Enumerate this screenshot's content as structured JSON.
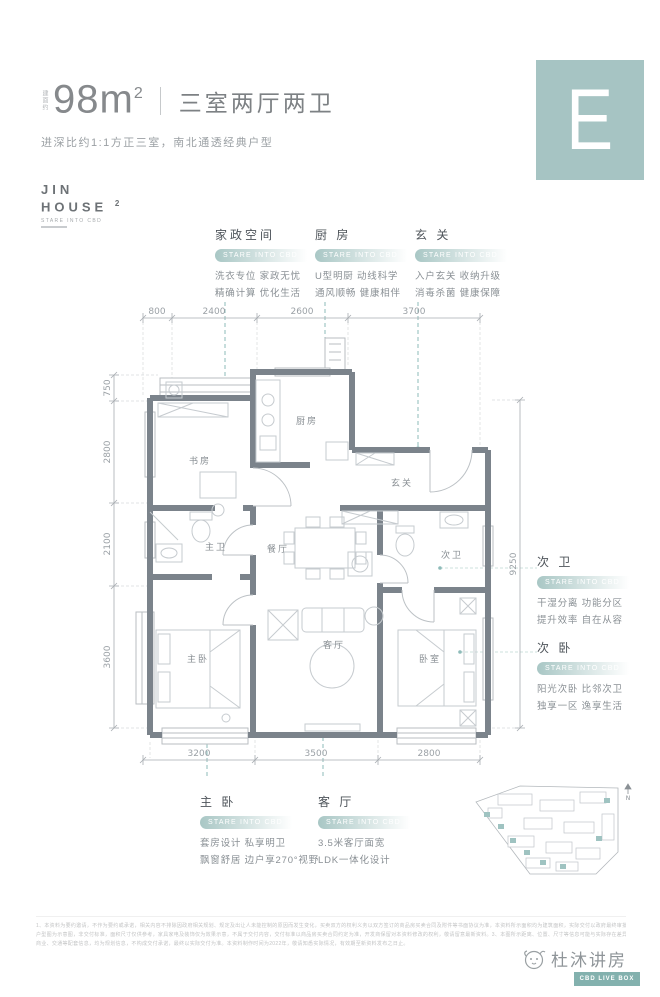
{
  "header": {
    "area_prefix": "建面约",
    "area_value": "98m",
    "area_sup": "2",
    "title": "三室两厅两卫",
    "subtitle": "进深比约1:1方正三室，南北通透经典户型",
    "tile_letter": "E"
  },
  "logo": {
    "line1": "JIN",
    "line2": "HOUSE",
    "sup": "2",
    "tagline": "STARE INTO CBD"
  },
  "badge_label": "STARE INTO CBD",
  "annotations": {
    "top": [
      {
        "title": "家政空间",
        "desc1": "洗衣专位 家政无忧",
        "desc2": "精确计算 优化生活"
      },
      {
        "title": "厨 房",
        "desc1": "U型明厨 动线科学",
        "desc2": "通风顺畅 健康相伴"
      },
      {
        "title": "玄 关",
        "desc1": "入户玄关 收纳升级",
        "desc2": "消毒杀菌 健康保障"
      }
    ],
    "right": [
      {
        "title": "次 卫",
        "desc1": "干湿分离 功能分区",
        "desc2": "提升效率 自在从容"
      },
      {
        "title": "次 卧",
        "desc1": "阳光次卧 比邻次卫",
        "desc2": "独享一区 逸享生活"
      }
    ],
    "bottom": [
      {
        "title": "主 卧",
        "desc1": "套房设计 私享明卫",
        "desc2": "飘窗舒居 边户享270°视野"
      },
      {
        "title": "客 厅",
        "desc1": "3.5米客厅面宽",
        "desc2": "LDK一体化设计"
      }
    ]
  },
  "plan": {
    "rooms": {
      "study": "书房",
      "kitchen": "厨房",
      "entry": "玄关",
      "dining": "餐厅",
      "master_bath": "主卫",
      "master_bed": "主卧",
      "living": "客厅",
      "second_bath": "次卫",
      "bedroom": "卧室"
    },
    "dims": {
      "top": [
        "800",
        "2400",
        "2600",
        "3700"
      ],
      "left": [
        "750",
        "2800",
        "2100",
        "3600"
      ],
      "bottom": [
        "3200",
        "3500",
        "2800"
      ],
      "right": [
        "9250"
      ]
    }
  },
  "siteplan": {
    "north_label": "N"
  },
  "footer": {
    "disclaimer_line1": "1、本资料为要约邀请，不作为要约或承诺，相关内容不排除因政府相关规划、规定及出让人未能控制的原因而发生变化，买卖双方的权利义务以双方签订的商品房买卖合同及附件等书面协议为准，本资料所示面积均为建筑面积，实际交付以政府最终审批文件及合同约定为准。2、本页所示",
    "disclaimer_line2": "户型图为示意图，非交付标准，面积尺寸仅供参考，家具家电及装饰仅为效果示意，不属于交付内容，交付标准以商品房买卖合同约定为准，开发商保留对本资料修改的权利，敬请留意最新资料。3、本图所示距离、位置、尺寸等信息可能与实际存在差异，最终以政府部门批准文件为准。文中所述学校、",
    "disclaimer_line3": "商业、交通等配套信息，均为规划信息，不构成交付承诺，最终以实际交付为准。本资料制作时间为2022年，敬请知悉实际情况，有效期至新资料发布之日止。",
    "brand": "杜沐讲房",
    "brand_bar": "CBD LIVE BOX"
  },
  "colors": {
    "accent": "#8ebbb9",
    "tile": "#a6c4c3",
    "wall": "#7b838b",
    "bar": "#83b1ae"
  }
}
